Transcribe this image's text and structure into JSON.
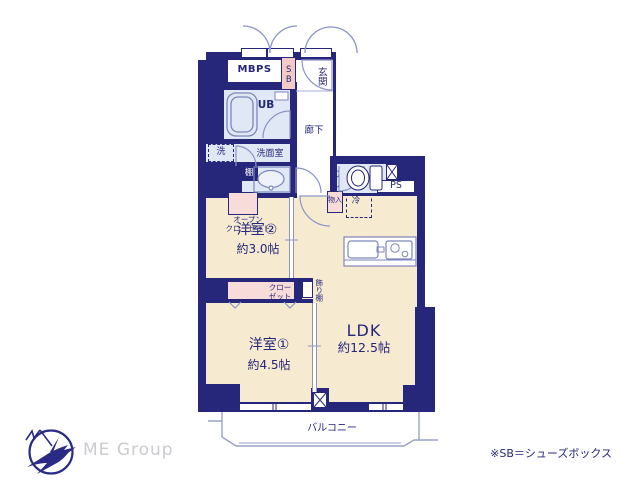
{
  "plan": {
    "rooms": {
      "mbps": "MBPS",
      "shoe_box": "SB",
      "entrance": "玄関",
      "unit_bath": "UB",
      "hallway": "廊下",
      "washer": "洗",
      "washroom": "洗面室",
      "shelf": "棚",
      "toilet": "トイレ",
      "pipe_space": "PS",
      "storage": "物入",
      "refrigerator": "冷",
      "open_closet_line1": "オープン",
      "open_closet_line2": "クローゼット",
      "western_room2": "洋室②",
      "western_room2_size": "約3.0帖",
      "closet_line1": "クロー",
      "closet_line2": "ゼット",
      "display_shelf": "飾り棚",
      "western_room1": "洋室①",
      "western_room1_size": "約4.5帖",
      "ldk": "LDK",
      "ldk_size": "約12.5帖",
      "balcony": "バルコニー"
    },
    "footnote": "※SB＝シューズボックス",
    "logo_text": "ME Group",
    "colors": {
      "wall": "#26267b",
      "room_cream": "#f6ebd0",
      "wet_blue": "#dfe8f4",
      "shoebox_pink": "#f3cac5",
      "closet_pink": "#f8dcda",
      "fixture_line": "#8c94c6",
      "text": "#26267b",
      "logo_gray": "#cbcbd0"
    }
  }
}
